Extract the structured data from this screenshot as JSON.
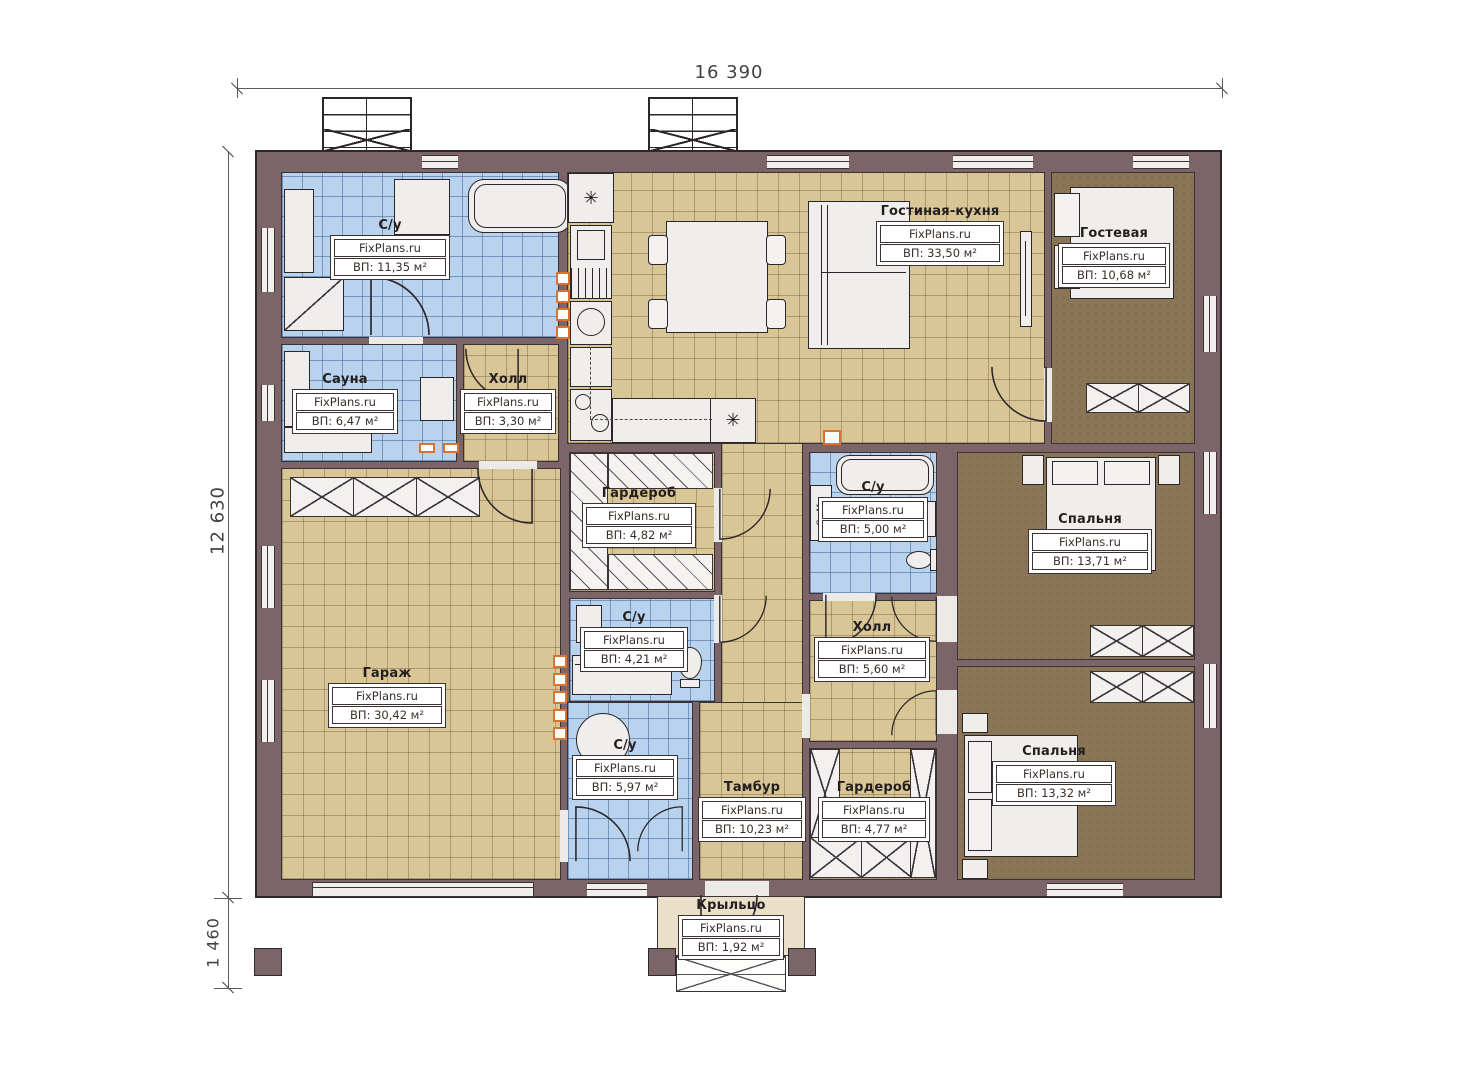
{
  "watermark": "FixPlans.ru",
  "dimensions": {
    "top": "16 390",
    "left": "12 630",
    "left_lower": "1 460"
  },
  "annotations": {
    "washing_machine": "Ст.М."
  },
  "rooms": [
    {
      "id": "su1",
      "name": "С/у",
      "area": "ВП: 11,35 м²"
    },
    {
      "id": "sauna",
      "name": "Сауна",
      "area": "ВП: 6,47 м²"
    },
    {
      "id": "hall1",
      "name": "Холл",
      "area": "ВП: 3,30 м²"
    },
    {
      "id": "living",
      "name": "Гостиная-кухня",
      "area": "ВП: 33,50 м²"
    },
    {
      "id": "guest",
      "name": "Гостевая",
      "area": "ВП: 10,68 м²"
    },
    {
      "id": "garage",
      "name": "Гараж",
      "area": "ВП: 30,42 м²"
    },
    {
      "id": "wardrobe1",
      "name": "Гардероб",
      "area": "ВП: 4,82 м²"
    },
    {
      "id": "su2",
      "name": "С/у",
      "area": "ВП: 4,21 м²"
    },
    {
      "id": "su3",
      "name": "С/у",
      "area": "ВП: 5,00 м²"
    },
    {
      "id": "hall2",
      "name": "Холл",
      "area": "ВП: 5,60 м²"
    },
    {
      "id": "bedroom1",
      "name": "Спальня",
      "area": "ВП: 13,71 м²"
    },
    {
      "id": "bedroom2",
      "name": "Спальня",
      "area": "ВП: 13,32 м²"
    },
    {
      "id": "su4",
      "name": "С/у",
      "area": "ВП: 5,97 м²"
    },
    {
      "id": "tambur",
      "name": "Тамбур",
      "area": "ВП: 10,23 м²"
    },
    {
      "id": "wardrobe2",
      "name": "Гардероб",
      "area": "ВП: 4,77 м²"
    },
    {
      "id": "porch",
      "name": "Крыльцо",
      "area": "ВП: 1,92 м²"
    }
  ],
  "colors": {
    "wall": "#7b6568",
    "tile_blue": "#b9d3ef",
    "tile_beige": "#d9c697",
    "floor_brown": "#8a7656",
    "vent_orange": "#db7230"
  }
}
